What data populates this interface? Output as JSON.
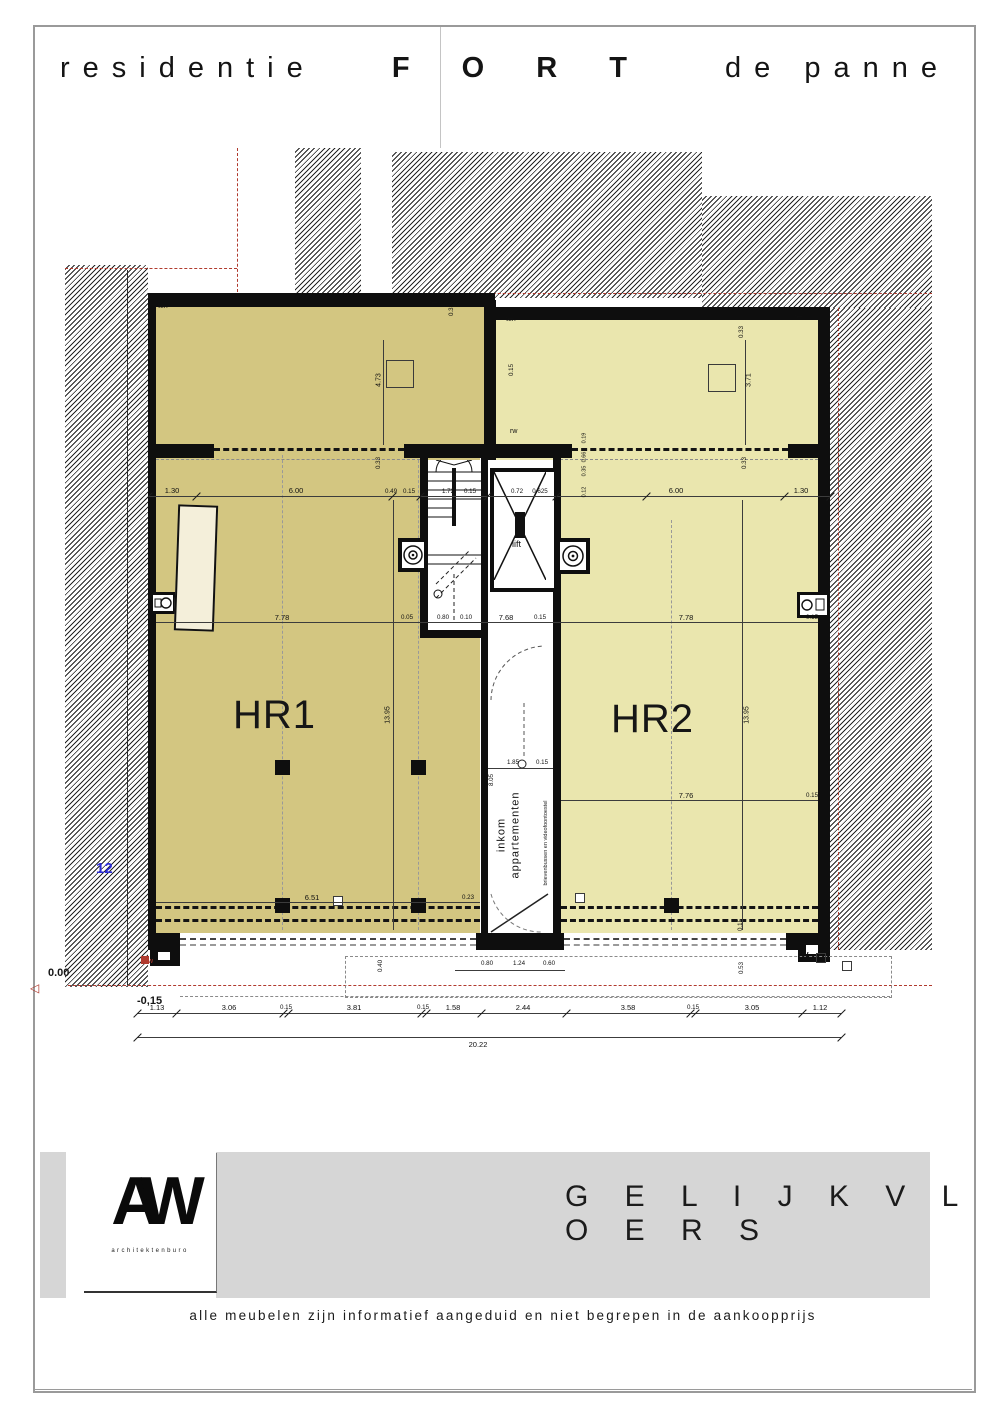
{
  "title": {
    "part1": "residentie",
    "part2": "F O R T",
    "part3": "de panne"
  },
  "plan": {
    "rooms": {
      "hr1": "HR1",
      "hr2": "HR2",
      "lift": "lift",
      "entrance_line1": "inkom",
      "entrance_line2": "appartementen",
      "entrance_note": "brievenbussen en videofoontoestel"
    },
    "labels": {
      "terr": "terr",
      "rw": "rw",
      "fw": "fw",
      "level_zero": "0.00",
      "level_minus": "-0,15",
      "block_number": "12",
      "marker": "◁"
    }
  },
  "dims": {
    "bottom": [
      "1.13",
      "3.06",
      "0.15",
      "3.81",
      "0.15",
      "1.58",
      "2.44",
      "3.58",
      "0.15",
      "3.05",
      "1.12"
    ],
    "total": "20.22",
    "mid_left": [
      "1.30",
      "6.00",
      "0.49",
      "0.15"
    ],
    "mid_right": [
      "6.00",
      "1.30"
    ],
    "core_top": [
      "1.72",
      "0.15",
      "0.72",
      "0.625"
    ],
    "row_a": [
      "7.78",
      "0.05",
      "0.80",
      "0.10",
      "7.68",
      "0.15",
      "7.78",
      "0.15"
    ],
    "corridor": [
      "1.85",
      "0.15"
    ],
    "hr2_row": [
      "7.76",
      "0.15"
    ],
    "hr1_row": [
      "6.51",
      "0.23"
    ],
    "entrance": [
      "0.80",
      "1.24",
      "0.60"
    ],
    "v_left_top": "4.73",
    "v_right_top": "3.71",
    "v_hr1": "13.95",
    "v_hr2": "13.95",
    "v_corridor": "8.05",
    "v_033": "0.33",
    "v_040": "0.40",
    "v_053": "0.53",
    "v_015": "0.15",
    "cluster": [
      "0.19",
      "0.66",
      "0.35",
      "0.12"
    ]
  },
  "footer": {
    "logo_text": "AW",
    "logo_sub": "architektenburo",
    "floor_label": "G E L I J K V L O E R S",
    "disclaimer": "alle meubelen zijn informatief aangeduid en niet begrepen in de aankoopprijs"
  },
  "colors": {
    "hr1": "#d3c681",
    "hr2": "#eae6ae",
    "band": "#d6d6d6",
    "red": "#b03a2e",
    "blue": "#2b2bd6"
  }
}
